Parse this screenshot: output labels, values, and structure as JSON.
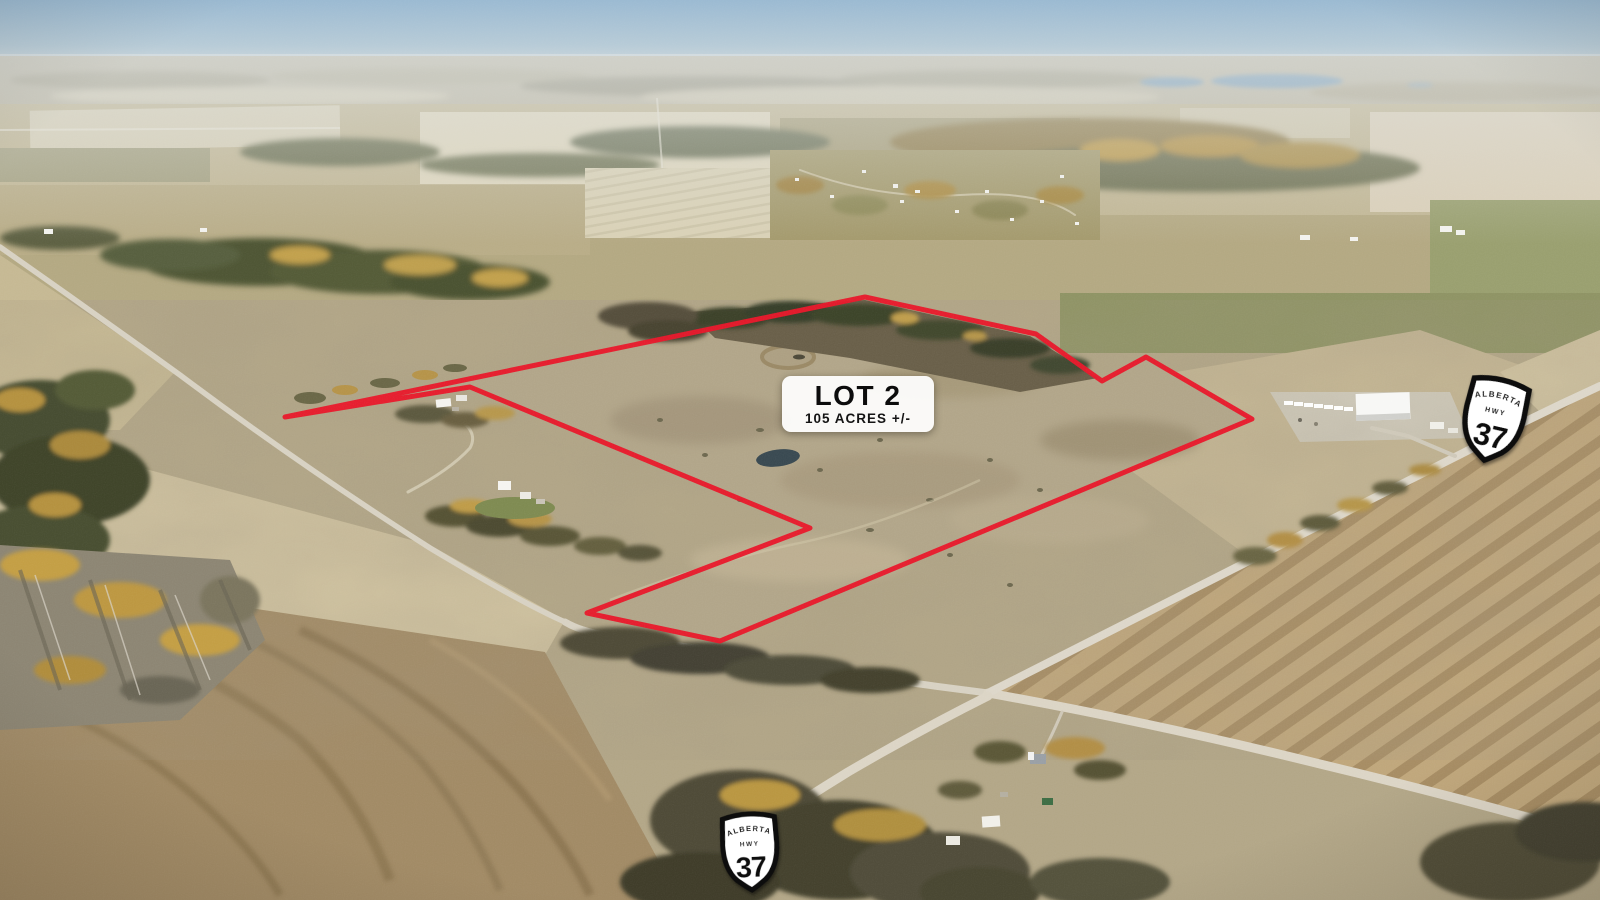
{
  "image": {
    "kind": "aerial-property-photo",
    "width": 1600,
    "height": 900
  },
  "lot_label": {
    "title": "LOT 2",
    "acreage": "105 ACRES +/-",
    "x": 782,
    "y": 376,
    "width": 152,
    "height": 56,
    "bg": "#ffffff",
    "text_color": "#111111"
  },
  "boundary": {
    "color": "#e8192c",
    "stroke_width": 5,
    "points": [
      [
        285,
        417
      ],
      [
        865,
        297
      ],
      [
        1036,
        334
      ],
      [
        1102,
        381
      ],
      [
        1146,
        357
      ],
      [
        1252,
        419
      ],
      [
        720,
        641
      ],
      [
        587,
        613
      ],
      [
        810,
        528
      ],
      [
        470,
        387
      ]
    ]
  },
  "highway_shields": [
    {
      "id": "ne",
      "province": "ALBERTA",
      "road_type": "HWY",
      "number": "37",
      "x": 1494,
      "y": 418,
      "rotation": 13,
      "scale": 1.08
    },
    {
      "id": "s",
      "province": "ALBERTA",
      "road_type": "HWY",
      "number": "37",
      "x": 750,
      "y": 850,
      "rotation": -3,
      "scale": 1.0
    }
  ],
  "scene_colors": {
    "sky": "#a5c0d4",
    "haze": "#d2dadd",
    "water": "#7d9fb8",
    "field_tan": "#c2ab81",
    "field_brown": "#a28b66",
    "field_pale": "#d8d0b6",
    "field_olive": "#8f9465",
    "pasture": "#b3a689",
    "road": "#d9d3c5",
    "tree_dark": "#4c5134",
    "tree_gold": "#c3a14e",
    "pond": "#3a4a52"
  }
}
